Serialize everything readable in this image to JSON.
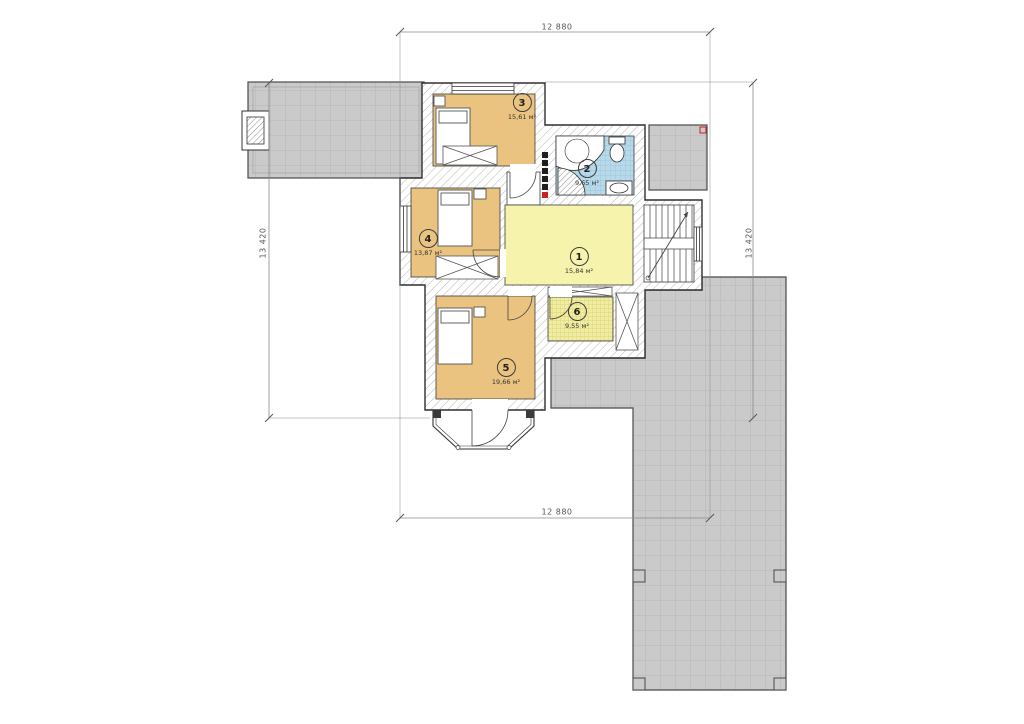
{
  "dimensions": {
    "top": "12 880",
    "bottom": "12 880",
    "left": "13 420",
    "right": "13 420"
  },
  "rooms": [
    {
      "number": "1",
      "area": "15,84 м²"
    },
    {
      "number": "2",
      "area": "9,65 м²"
    },
    {
      "number": "3",
      "area": "15,61 м²"
    },
    {
      "number": "4",
      "area": "13,87 м²"
    },
    {
      "number": "5",
      "area": "19,66 м²"
    },
    {
      "number": "6",
      "area": "9,55 м²"
    }
  ],
  "colors": {
    "room-tan": "#e9c37f",
    "room-yellow": "#f6f3ad",
    "room-yellow-tile": "#f1eda0",
    "room-blue": "#b7d9ea",
    "roof-gray": "#cacaca",
    "wall-outline": "#2f2f2f",
    "accent-red": "#cc2222",
    "dim-line": "#8a8a8a"
  }
}
